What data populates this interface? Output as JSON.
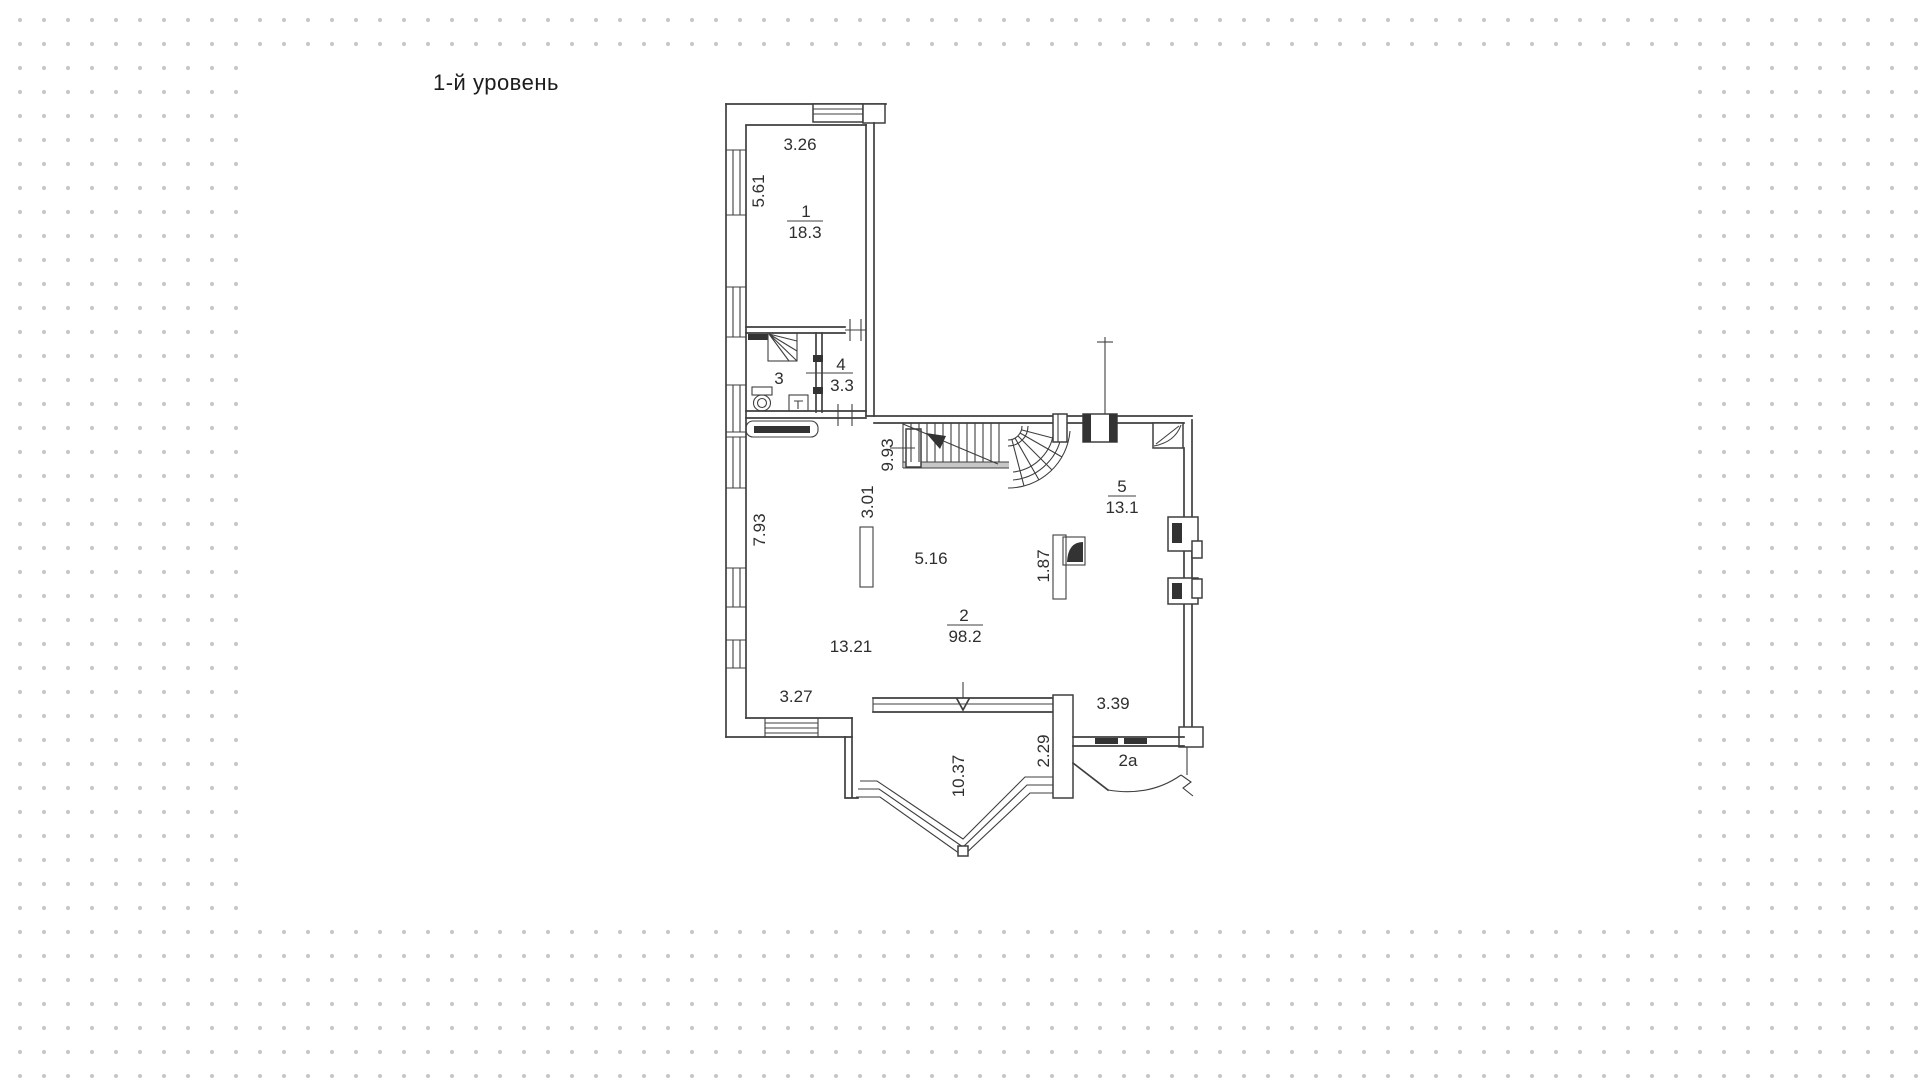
{
  "title": "1-й уровень",
  "colors": {
    "line": "#3f3f3f",
    "dot": "#c5c5c8",
    "canvas": "#ffffff",
    "ink": "#2e2e2e"
  },
  "plan": {
    "rooms": {
      "r1": {
        "num": "1",
        "area": "18.3"
      },
      "r2": {
        "num": "2",
        "area": "98.2"
      },
      "r2a": {
        "num": "2а"
      },
      "r3": {
        "num": "3"
      },
      "r4": {
        "num": "4",
        "area": "3.3"
      },
      "r5": {
        "num": "5",
        "area": "13.1"
      }
    },
    "dims": {
      "top_width": "3.26",
      "room1_height": "5.61",
      "stair_run": "9.93",
      "column": "3.01",
      "left_height": "7.93",
      "hall_width": "5.16",
      "fireplace": "1.87",
      "main_width": "13.21",
      "bottom_left": "3.27",
      "bay_girth": "10.37",
      "bay_depth": "2.29",
      "entry_width": "3.39"
    }
  }
}
